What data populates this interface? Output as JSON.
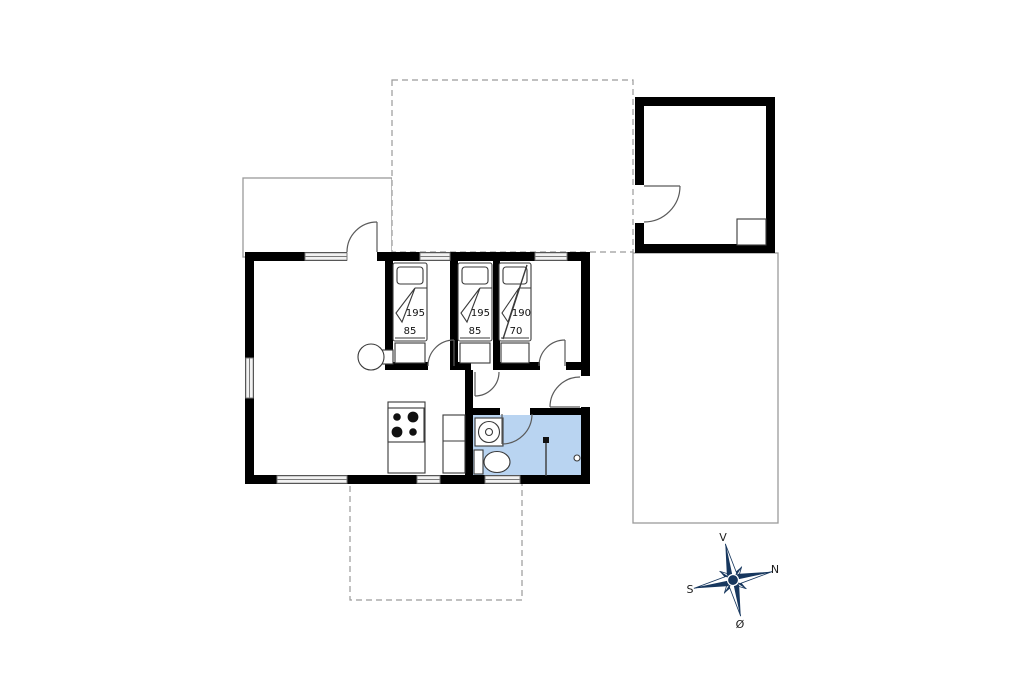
{
  "floorplan": {
    "bedrooms": [
      {
        "bed_length_cm": "195",
        "bed_width_cm": "85"
      },
      {
        "bed_length_cm": "195",
        "bed_width_cm": "85"
      },
      {
        "bed_length_cm": "190",
        "bed_width_cm": "70"
      }
    ],
    "compass": {
      "up": "V",
      "upper_right": "N",
      "lower_left": "S",
      "down": "Ø"
    },
    "colors": {
      "wall": "#000000",
      "bathroom_fill": "#b9d4f1",
      "compass_navy": "#17375e",
      "terrace_line": "#9a9a9a"
    }
  }
}
